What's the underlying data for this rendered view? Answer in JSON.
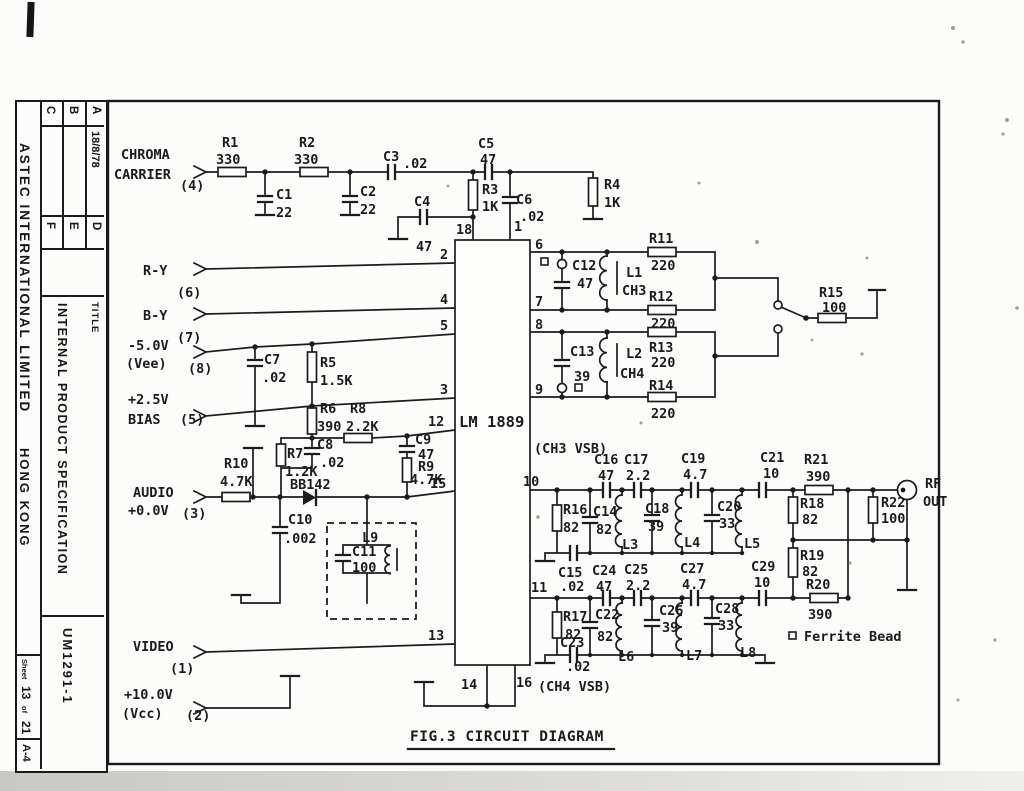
{
  "meta": {
    "fig_caption": "FIG.3 CIRCUIT DIAGRAM",
    "ic_name": "LM 1889",
    "ch3_note": "(CH3 VSB)",
    "ch4_note": "(CH4 VSB)",
    "ferrite_symbol": "¤",
    "ferrite_note": "Ferrite Bead",
    "rf_line1": "RF",
    "rf_line2": "OUT",
    "colors": {
      "ink": "#1c1c1c",
      "paper": "#fcfcfa"
    }
  },
  "titleblock": {
    "company": "ASTEC INTERNATIONAL LIMITED",
    "city": "HONG KONG",
    "title_label": "TITLE",
    "title": "INTERNAL PRODUCT SPECIFICATION",
    "doc": "UM1291-1",
    "sheet_label": "Sheet",
    "sheet_no": "13",
    "of_label": "of",
    "total": "21",
    "size": "A-4",
    "grid": {
      "a": "A",
      "b": "B",
      "c": "C",
      "d": "D",
      "e": "E",
      "f": "F",
      "date": "18/8/78"
    }
  },
  "inputs": {
    "chroma1": "CHROMA",
    "chroma2": "CARRIER",
    "chroma_pin": "(4)",
    "ry": "R-Y",
    "ry_pin": "(6)",
    "by": "B-Y",
    "by_pin": "(7)",
    "vee1": "-5.0V",
    "vee2": "(Vee)",
    "vee_pin": "(8)",
    "bias1": "+2.5V",
    "bias2": "BIAS",
    "bias_pin": "(5)",
    "audio1": "AUDIO",
    "audio2": "+0.0V",
    "audio_pin": "(3)",
    "video": "VIDEO",
    "video_pin": "(1)",
    "vcc1": "+10.0V",
    "vcc2": "(Vcc)",
    "vcc_pin": "(2)"
  },
  "pins": {
    "p1": "1",
    "p2": "2",
    "p3": "3",
    "p4": "4",
    "p5": "5",
    "p6": "6",
    "p7": "7",
    "p8": "8",
    "p9": "9",
    "p10": "10",
    "p11": "11",
    "p12": "12",
    "p13": "13",
    "p14": "14",
    "p15": "15",
    "p16": "16",
    "p18": "18"
  },
  "parts": {
    "r1": "R1",
    "r1v": "330",
    "r2": "R2",
    "r2v": "330",
    "r3": "R3",
    "r3v": "1K",
    "r4": "R4",
    "r4v": "1K",
    "r5": "R5",
    "r5v": "1.5K",
    "r6": "R6",
    "r6v": "390",
    "r7": "R7",
    "r7v": "1.2K",
    "r8": "R8",
    "r8v": "2.2K",
    "r9": "R9",
    "r9v": "4.7K",
    "r10": "R10",
    "r10v": "4.7K",
    "r11": "R11",
    "r11v": "220",
    "r12": "R12",
    "r12v": "220",
    "r13": "R13",
    "r13v": "220",
    "r14": "R14",
    "r14v": "220",
    "r15": "R15",
    "r15v": "100",
    "r16": "R16",
    "r16v": "82",
    "r17": "R17",
    "r17v": "82",
    "r18": "R18",
    "r18v": "82",
    "r19": "R19",
    "r19v": "82",
    "r20": "R20",
    "r20v": "390",
    "r21": "R21",
    "r21v": "390",
    "r22": "R22",
    "r22v": "100",
    "c1": "C1",
    "c1v": "22",
    "c2": "C2",
    "c2v": "22",
    "c3": "C3",
    "c3v": ".02",
    "c4": "C4",
    "c4v": "47",
    "c5": "C5",
    "c5v": "47",
    "c6": "C6",
    "c6v": ".02",
    "c7": "C7",
    "c7v": ".02",
    "c8": "C8",
    "c8v": ".02",
    "c9": "C9",
    "c9v": "47",
    "c10": "C10",
    "c10v": ".002",
    "c11": "C11",
    "c11v": "100",
    "c12": "C12",
    "c12v": "47",
    "c13": "C13",
    "c13v": "39",
    "c14": "C14",
    "c14v": "82",
    "c15": "C15",
    "c15v": ".02",
    "c16": "C16",
    "c16v": "47",
    "c17": "C17",
    "c17v": "2.2",
    "c18": "C18",
    "c18v": "39",
    "c19": "C19",
    "c19v": "4.7",
    "c20": "C20",
    "c20v": "33",
    "c21": "C21",
    "c21v": "10",
    "c22": "C22",
    "c22v": "82",
    "c23": "C23",
    "c23v": ".02",
    "c24": "C24",
    "c24v": "47",
    "c25": "C25",
    "c25v": "2.2",
    "c26": "C26",
    "c26v": "39",
    "c27": "C27",
    "c27v": "4.7",
    "c28": "C28",
    "c28v": "33",
    "c29": "C29",
    "c29v": "10",
    "l1": "L1",
    "l1v": "CH3",
    "l2": "L2",
    "l2v": "CH4",
    "l3": "L3",
    "l4": "L4",
    "l5": "L5",
    "l6": "L6",
    "l7": "L7",
    "l8": "L8",
    "l9": "L9",
    "d1": "BB142"
  }
}
